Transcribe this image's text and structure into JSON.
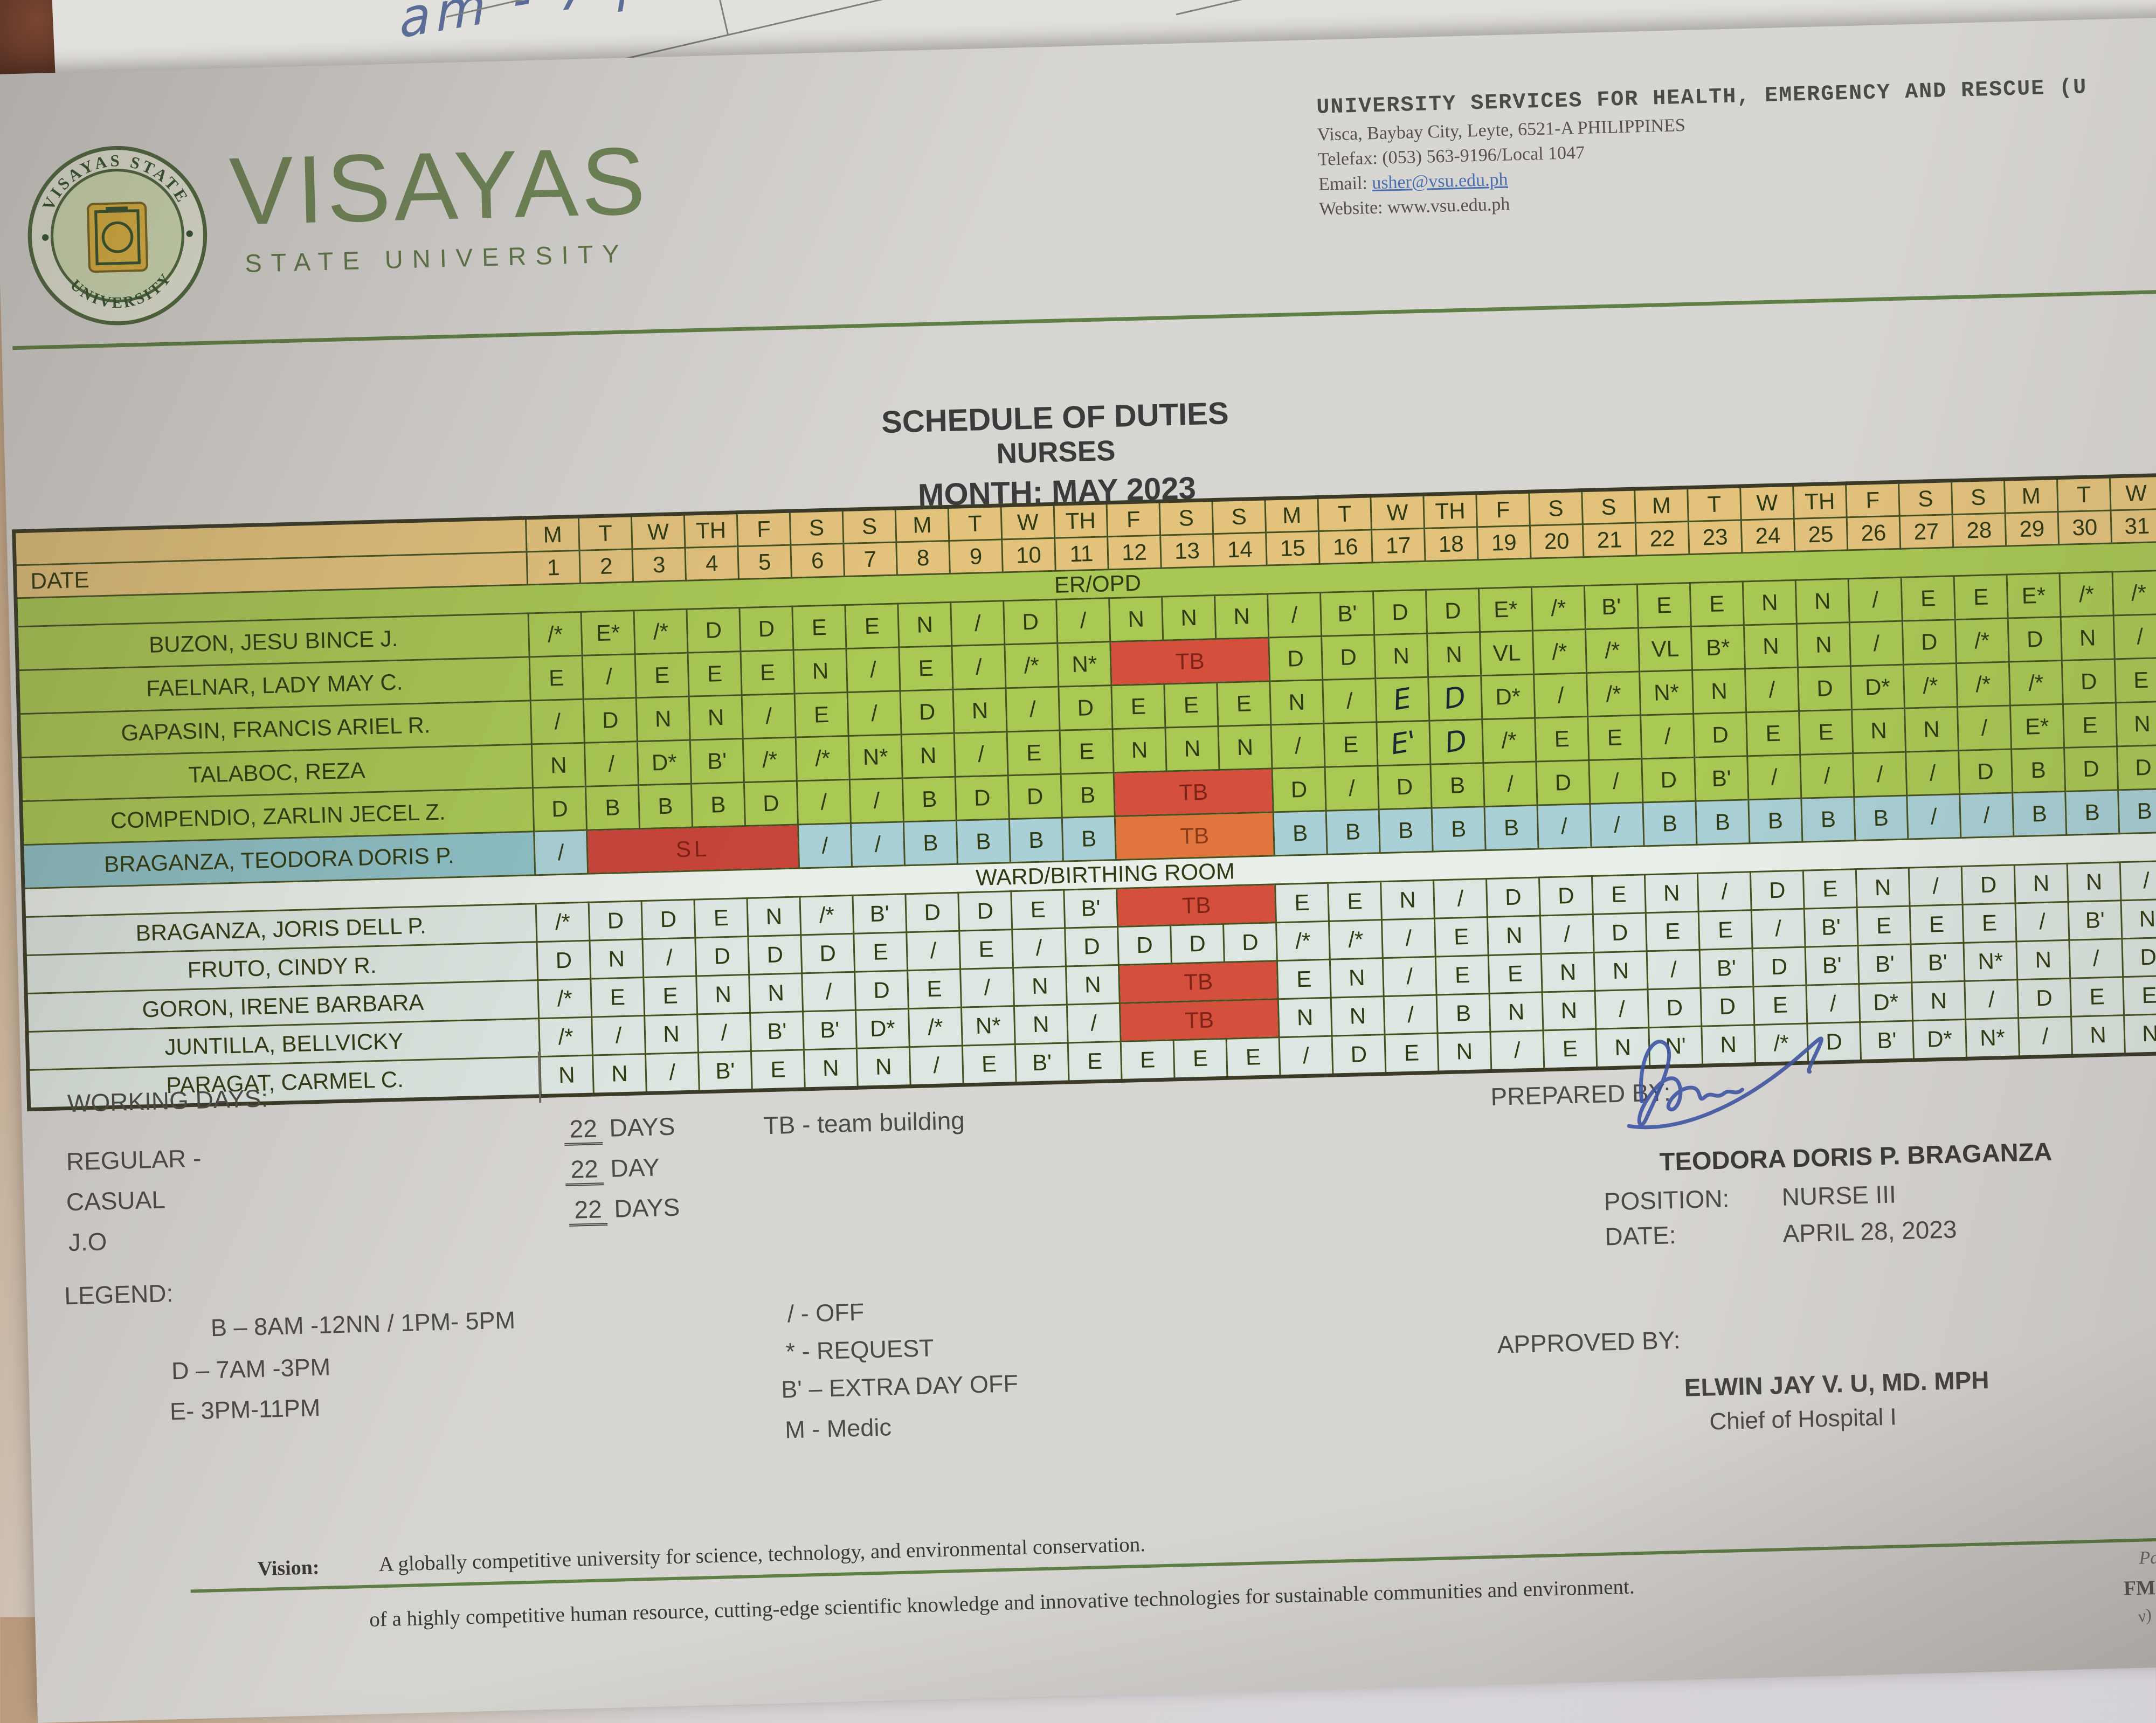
{
  "colors": {
    "accent_green": "#5f7f45",
    "table_green": "#a9c854",
    "header_tan": "#e3c27c",
    "highlight_blue": "#a9d0d6",
    "tb_red": "#d4503c",
    "tb_orange": "#e0753e",
    "sl_red": "#c7443a"
  },
  "background": {
    "driver": "DRIVER",
    "caintic": "CAINTIC",
    "handwriting": "am - 7 pm)"
  },
  "header": {
    "wordmark": "VISAYAS",
    "wordmark_sub": "STATE UNIVERSITY",
    "seal_top": "VISAYAS STATE",
    "seal_bottom": "UNIVERSITY",
    "org_line": "UNIVERSITY SERVICES FOR HEALTH, EMERGENCY AND RESCUE (U",
    "address": "Visca, Baybay City, Leyte, 6521-A PHILIPPINES",
    "telefax": "Telefax: (053) 563-9196/Local 1047",
    "email_label": "Email: ",
    "email": "usher@vsu.edu.ph",
    "website_label": "Website: ",
    "website": "www.vsu.edu.ph"
  },
  "title": {
    "line1": "SCHEDULE OF DUTIES",
    "line2": "NURSES",
    "line3": "MONTH: MAY  2023"
  },
  "table": {
    "date_label": "DATE",
    "days": [
      "M",
      "T",
      "W",
      "TH",
      "F",
      "S",
      "S",
      "M",
      "T",
      "W",
      "TH",
      "F",
      "S",
      "S",
      "M",
      "T",
      "W",
      "TH",
      "F",
      "S",
      "S",
      "M",
      "T",
      "W",
      "TH",
      "F",
      "S",
      "S",
      "M",
      "T",
      "W"
    ],
    "dates": [
      "1",
      "2",
      "3",
      "4",
      "5",
      "6",
      "7",
      "8",
      "9",
      "10",
      "11",
      "12",
      "13",
      "14",
      "15",
      "16",
      "17",
      "18",
      "19",
      "20",
      "21",
      "22",
      "23",
      "24",
      "25",
      "26",
      "27",
      "28",
      "29",
      "30",
      "31"
    ],
    "sections": [
      {
        "label": "ER/OPD",
        "style": "green",
        "rows": [
          {
            "name": "BUZON, JESU BINCE J.",
            "cells": [
              "/*",
              "E*",
              "/*",
              "D",
              "D",
              "E",
              "E",
              "N",
              "/",
              "D",
              "/",
              "N",
              "N",
              "N",
              "/",
              "B'",
              "D",
              "D",
              "E*",
              "/*",
              "B'",
              "E",
              "E",
              "N",
              "N",
              "/",
              "E",
              "E",
              "E*",
              "/*",
              "/*"
            ]
          },
          {
            "name": "FAELNAR, LADY MAY C.",
            "cells": [
              "E",
              "/",
              "E",
              "E",
              "E",
              "N",
              "/",
              "E",
              "/",
              "/*",
              "N*",
              {
                "label": "TB",
                "span": 3,
                "cls": "tb"
              },
              "D",
              "D",
              "N",
              "N",
              "VL",
              "/*",
              "/*",
              "VL",
              "B*",
              "N",
              "N",
              "/",
              "D",
              "/*",
              "D",
              "N",
              "/"
            ]
          },
          {
            "name": "GAPASIN, FRANCIS ARIEL R.",
            "cells": [
              "/",
              "D",
              "N",
              "N",
              "/",
              "E",
              "/",
              "D",
              "N",
              "/",
              "D",
              "E",
              "E",
              "E",
              "N",
              "/",
              {
                "label": "E",
                "cls": "hand"
              },
              {
                "label": "D",
                "cls": "hand"
              },
              "D*",
              "/",
              "/*",
              "N*",
              "N",
              "/",
              "D",
              "D*",
              "/*",
              "/*",
              "/*",
              "D",
              "E"
            ]
          },
          {
            "name": "TALABOC, REZA",
            "cells": [
              "N",
              "/",
              "D*",
              "B'",
              "/*",
              "/*",
              "N*",
              "N",
              "/",
              "E",
              "E",
              "N",
              "N",
              "N",
              "/",
              "E",
              {
                "label": "E'",
                "cls": "hand"
              },
              {
                "label": "D",
                "cls": "hand"
              },
              "/*",
              "E",
              "E",
              "/",
              "D",
              "E",
              "E",
              "N",
              "N",
              "/",
              "E*",
              "E",
              "N"
            ]
          },
          {
            "name": "COMPENDIO, ZARLIN JECEL Z.",
            "cells": [
              "D",
              "B",
              "B",
              "B",
              "D",
              "/",
              "/",
              "B",
              "D",
              "D",
              "B",
              {
                "label": "TB",
                "span": 3,
                "cls": "tb"
              },
              "D",
              "/",
              "D",
              "B",
              "/",
              "D",
              "/",
              "D",
              "B'",
              "/",
              "/",
              "/",
              "/",
              "D",
              "B",
              "D",
              "D"
            ]
          },
          {
            "name": "BRAGANZA, TEODORA DORIS P.",
            "highlight": true,
            "cells": [
              "/",
              {
                "label": "SL",
                "span": 4,
                "cls": "sl"
              },
              "/",
              "/",
              "B",
              "B",
              "B",
              "B",
              {
                "label": "TB",
                "span": 3,
                "cls": "tb-o"
              },
              "B",
              "B",
              "B",
              "B",
              "B",
              "/",
              "/",
              "B",
              "B",
              "B",
              "B",
              "B",
              "/",
              "/",
              "B",
              "B",
              "B"
            ]
          }
        ]
      },
      {
        "label": "WARD/BIRTHING ROOM",
        "style": "ward",
        "rows": [
          {
            "name": "BRAGANZA, JORIS DELL P.",
            "cells": [
              "/*",
              "D",
              "D",
              "E",
              "N",
              "/*",
              "B'",
              "D",
              "D",
              "E",
              "B'",
              {
                "label": "TB",
                "span": 3,
                "cls": "tb"
              },
              "E",
              "E",
              "N",
              "/",
              "D",
              "D",
              "E",
              "N",
              "/",
              "D",
              "E",
              "N",
              "/",
              "D",
              "N",
              "N",
              "/"
            ]
          },
          {
            "name": "FRUTO, CINDY R.",
            "cells": [
              "D",
              "N",
              "/",
              "D",
              "D",
              "D",
              "E",
              "/",
              "E",
              "/",
              "D",
              "D",
              "D",
              "D",
              "/*",
              "/*",
              "/",
              "E",
              "N",
              "/",
              "D",
              "E",
              "E",
              "/",
              "B'",
              "E",
              "E",
              "E",
              "/",
              "B'",
              "N"
            ]
          },
          {
            "name": "GORON, IRENE BARBARA",
            "cells": [
              "/*",
              "E",
              "E",
              "N",
              "N",
              "/",
              "D",
              "E",
              "/",
              "N",
              "N",
              {
                "label": "TB",
                "span": 3,
                "cls": "tb"
              },
              "E",
              "N",
              "/",
              "E",
              "E",
              "N",
              "N",
              "/",
              "B'",
              "D",
              "B'",
              "B'",
              "B'",
              "N*",
              "N",
              "/",
              "D"
            ]
          },
          {
            "name": "JUNTILLA, BELLVICKY",
            "cells": [
              "/*",
              "/",
              "N",
              "/",
              "B'",
              "B'",
              "D*",
              "/*",
              "N*",
              "N",
              "/",
              {
                "label": "TB",
                "span": 3,
                "cls": "tb"
              },
              "N",
              "N",
              "/",
              "B",
              "N",
              "N",
              "/",
              "D",
              "D",
              "E",
              "/",
              "D*",
              "N",
              "/",
              "D",
              "E",
              "E"
            ]
          },
          {
            "name": "PARAGAT, CARMEL C.",
            "cells": [
              "N",
              "N",
              "/",
              "B'",
              "E",
              "N",
              "N",
              "/",
              "E",
              "B'",
              "E",
              "E",
              "E",
              "E",
              "/",
              "D",
              "E",
              "N",
              "/",
              "E",
              "N",
              "N'",
              "N",
              "/*",
              "D",
              "B'",
              "D*",
              "N*",
              "/",
              "N",
              "N"
            ]
          }
        ]
      }
    ]
  },
  "footer": {
    "working_days": {
      "label": "WORKING DAYS:",
      "rows": [
        {
          "label": "REGULAR -",
          "num": "22",
          "unit": "DAYS"
        },
        {
          "label": "CASUAL",
          "num": "22",
          "unit": "DAY"
        },
        {
          "label": "J.O",
          "num": "22",
          "unit": "DAYS"
        }
      ],
      "tb_note": "TB - team building"
    },
    "legend": {
      "label": "LEGEND:",
      "left": [
        "B – 8AM -12NN / 1PM- 5PM",
        "D – 7AM -3PM",
        "E- 3PM-11PM"
      ],
      "right": [
        "/ - OFF",
        "* - REQUEST",
        "B' – EXTRA DAY OFF",
        "M  - Medic"
      ]
    },
    "prepared": {
      "label": "PREPARED BY:",
      "name": "TEODORA DORIS P. BRAGANZA",
      "position_label": "POSITION:",
      "position": "NURSE III",
      "date_label": "DATE:",
      "date": "APRIL 28, 2023"
    },
    "approved": {
      "label": "APPROVED BY:",
      "name": "ELWIN JAY V. U, MD. MPH",
      "title": "Chief of Hospital I"
    }
  },
  "bottom": {
    "vision_label": "Vision:",
    "vision_text": "A globally competitive university for science, technology, and environmental conservation.",
    "vision_text2": "of a highly competitive human resource, cutting-edge scientific knowledge and innovative technologies for sustainable communities and environment.",
    "page_fragment": "Page",
    "fm_fragment": "FM-U",
    "v_fragment": "v) 0"
  }
}
